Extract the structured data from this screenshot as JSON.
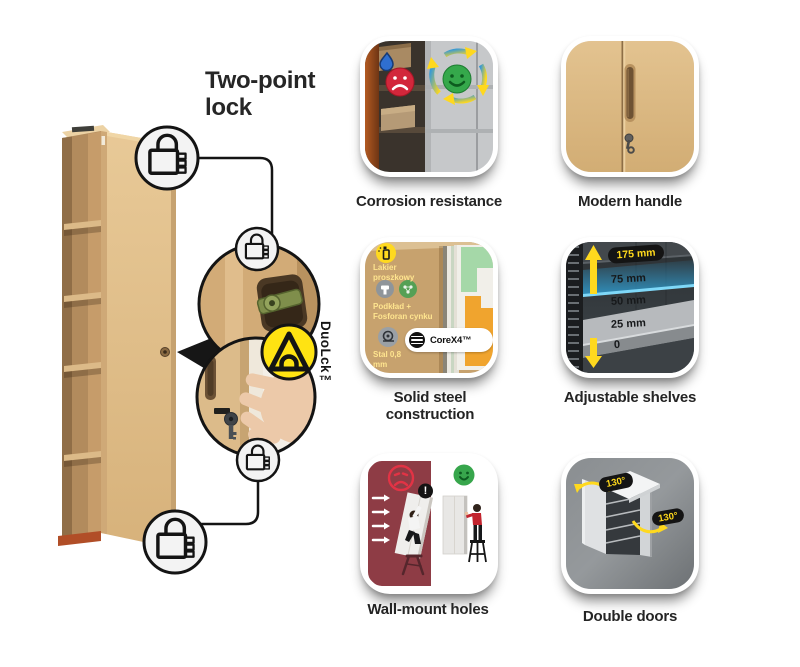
{
  "title": "Two-point lock",
  "lock_badge": {
    "label": "DuoLck™"
  },
  "tiles": {
    "corrosion": {
      "caption": "Corrosion resistance"
    },
    "handle": {
      "caption": "Modern handle"
    },
    "steel": {
      "caption": "Solid steel construction",
      "layer_labels": [
        "Lakier proszkowy",
        "Podkład + Fosforan cynku",
        "Stal 0,8 mm"
      ],
      "brand_badge": "CoreX4™"
    },
    "shelves": {
      "caption": "Adjustable shelves",
      "highlight_measurement": "175 mm",
      "measurements": [
        "75 mm",
        "50 mm",
        "25 mm",
        "0"
      ]
    },
    "wallmount": {
      "caption": "Wall-mount holes",
      "warning_mark": "!"
    },
    "doors": {
      "caption": "Double doors",
      "door_angles": [
        "130°",
        "130°"
      ]
    }
  },
  "icons": {
    "padlock": "padlock-icon",
    "duolck_triangle": "triangle-lock-logo",
    "sad_face": "sad-face-icon",
    "happy_face": "happy-face-icon",
    "water_drop": "water-drop-icon"
  },
  "colors": {
    "accent_yellow": "#ffe312",
    "cabinet_tan": "#dcba85",
    "ink": "#161616",
    "panel_red": "#8e3c45",
    "ok_green": "#37a64c",
    "bad_red": "#d2273b",
    "highlight_blue": "#2f9fd4"
  }
}
